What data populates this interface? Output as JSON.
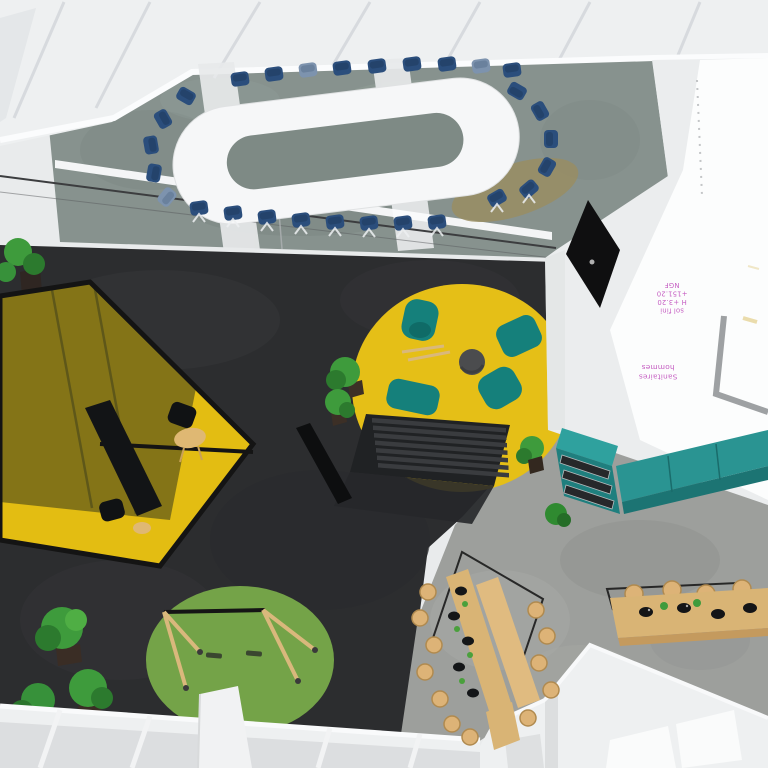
{
  "annotations": {
    "floor_note": {
      "lines": [
        "sol fini",
        "H +3.20",
        "+151.20",
        "NGF"
      ],
      "rotation_deg": 180
    },
    "room_label": {
      "lines": [
        "Sanitaires",
        "hommes"
      ],
      "rotation_deg": 180
    }
  },
  "colors": {
    "carpet": "#87928e",
    "dark_floor": "#2c2d2f",
    "concrete": "#9d9f9c",
    "facade": "#eef0f1",
    "wall_white": "#ebedee",
    "plan_sheet": "#fcfdfd",
    "table_white": "#f6f7f8",
    "chair_blue": "#2b4e7c",
    "chair_blue_light": "#7d93ae",
    "booth_yellow": "#e3bd12",
    "booth_canopy": "#6f6418",
    "frame_black": "#141414",
    "rug_yellow": "#e5bf17",
    "rug_green": "#74a348",
    "seat_teal": "#15807b",
    "counter_teal": "#2a9492",
    "wood": "#d9b475",
    "stool_wood": "#ddb377",
    "plant_green": "#3e9b3c",
    "screen_black": "#0f0f10",
    "annotation_pink": "#c55ec2",
    "plan_wall_gray": "#8d9093"
  },
  "objects": [
    "conference table",
    "conference chairs",
    "glass partition",
    "ceiling beams",
    "window facade",
    "meeting booth with canopy",
    "booth table",
    "booth chairs",
    "lounge rug",
    "lounge armchairs",
    "rocking chair",
    "pouf",
    "tiered bench",
    "console bench",
    "swing frame",
    "swing rug",
    "potted plants",
    "cafe tables",
    "stools",
    "bowls",
    "pendant frames",
    "kitchen shelf",
    "kitchen counter",
    "wall screen",
    "floor plan annotations"
  ]
}
